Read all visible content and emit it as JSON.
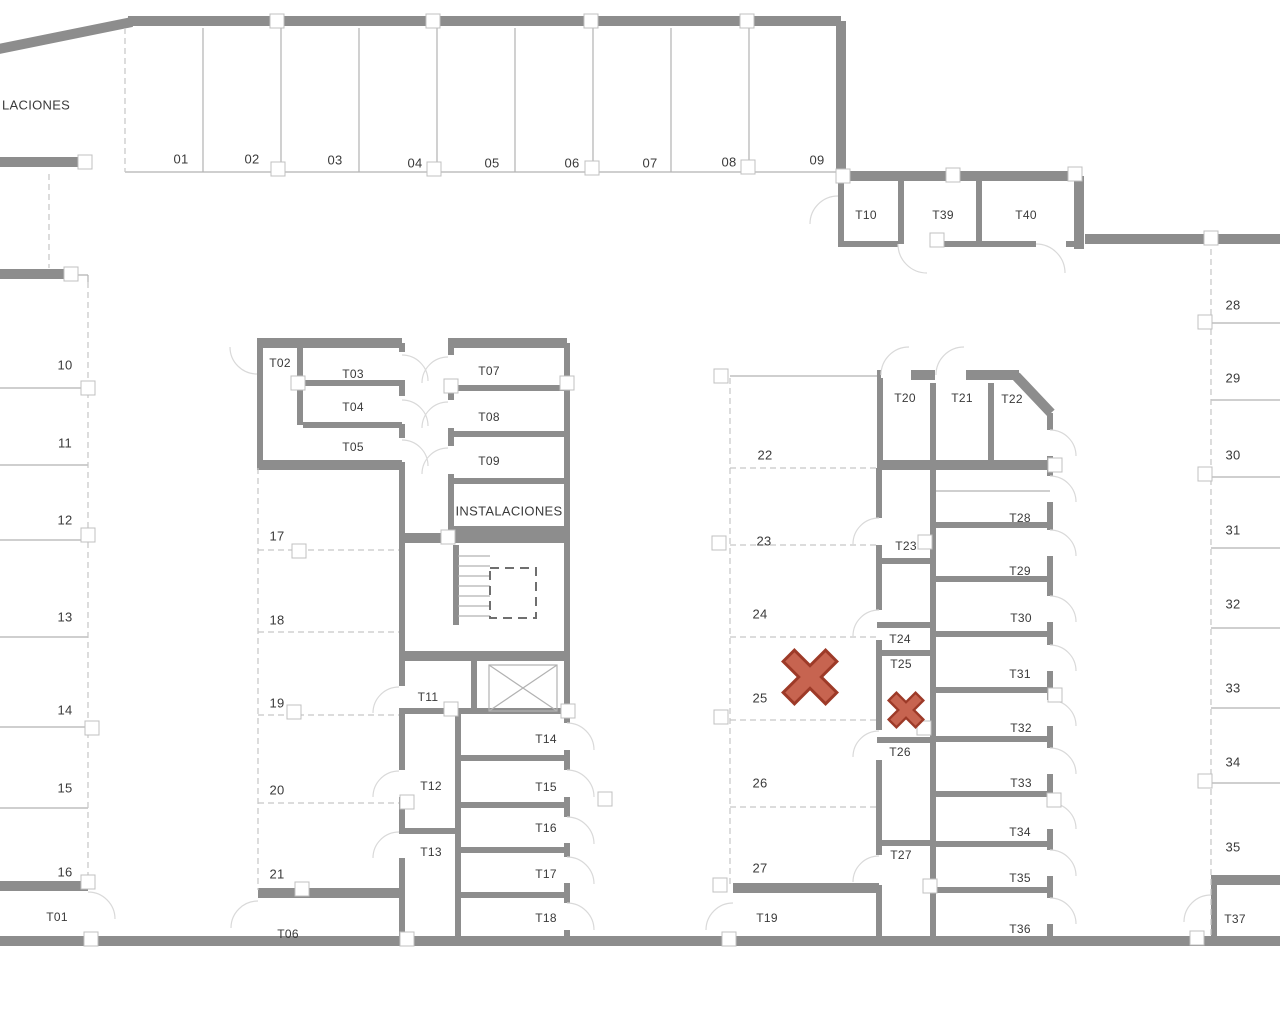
{
  "plan": {
    "area_label_truncated": "LACIONES",
    "utility_room_label": "INSTALACIONES",
    "parking": {
      "top": [
        "01",
        "02",
        "03",
        "04",
        "05",
        "06",
        "07",
        "08",
        "09"
      ],
      "left": [
        "10",
        "11",
        "12",
        "13",
        "14",
        "15",
        "16"
      ],
      "mid_left": [
        "17",
        "18",
        "19",
        "20",
        "21"
      ],
      "mid_right": [
        "22",
        "23",
        "24",
        "25",
        "26",
        "27"
      ],
      "right": [
        "28",
        "29",
        "30",
        "31",
        "32",
        "33",
        "34",
        "35"
      ]
    },
    "storage": {
      "t01": "T01",
      "t02": "T02",
      "t03": "T03",
      "t04": "T04",
      "t05": "T05",
      "t06": "T06",
      "t07": "T07",
      "t08": "T08",
      "t09": "T09",
      "t10": "T10",
      "t11": "T11",
      "t12": "T12",
      "t13": "T13",
      "t14": "T14",
      "t15": "T15",
      "t16": "T16",
      "t17": "T17",
      "t18": "T18",
      "t19": "T19",
      "t20": "T20",
      "t21": "T21",
      "t22": "T22",
      "t23": "T23",
      "t24": "T24",
      "t25": "T25",
      "t26": "T26",
      "t27": "T27",
      "t28": "T28",
      "t29": "T29",
      "t30": "T30",
      "t31": "T31",
      "t32": "T32",
      "t33": "T33",
      "t34": "T34",
      "t35": "T35",
      "t36": "T36",
      "t37": "T37",
      "t39": "T39",
      "t40": "T40"
    }
  },
  "annotations": {
    "x_marks": [
      {
        "size": "large",
        "location_label": "25"
      },
      {
        "size": "small",
        "location_label": "T25"
      }
    ]
  },
  "colors": {
    "wall": "#8d8d8d",
    "line": "#b2b2b2",
    "dashed": "#c6c6c6",
    "marker_border": "#c0c0c0",
    "arc": "#d9d9d9",
    "elevator_dash": "#6f6f6f",
    "x_fill": "#c76450",
    "x_stroke": "#9d3a28"
  }
}
